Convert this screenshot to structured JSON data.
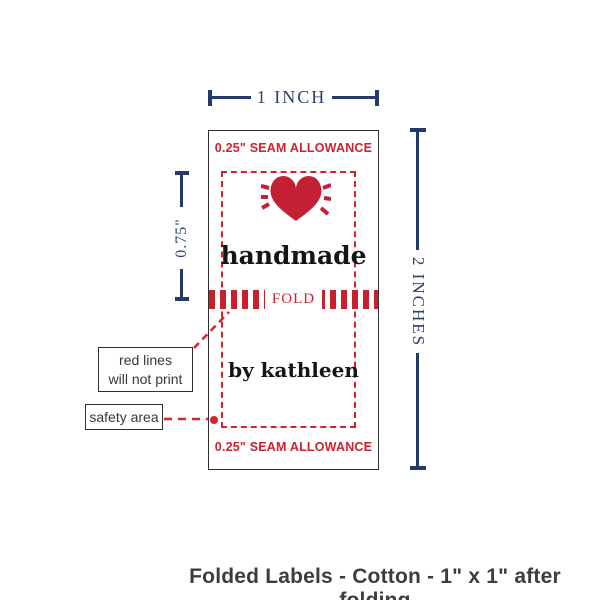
{
  "colors": {
    "navy": "#253a6b",
    "red": "#cf2130",
    "heart_red": "#c32133",
    "ink": "#151515",
    "outline": "#2f2f2f",
    "caption_gray": "#3d3d3d"
  },
  "dimensions": {
    "width_label": "1 INCH",
    "height_label": "2 INCHES",
    "fold_half_label": "0.75\""
  },
  "label": {
    "seam_top": "0.25\" SEAM ALLOWANCE",
    "seam_bottom": "0.25\" SEAM ALLOWANCE",
    "heart_icon": "heart-with-rays",
    "brand_line1": "handmade",
    "fold_label": "FOLD",
    "brand_line2": "by kathleen"
  },
  "callouts": {
    "red_lines": {
      "line1": "red lines",
      "line2": "will not print"
    },
    "safety_area": {
      "label": "safety area"
    }
  },
  "caption": {
    "text": "Folded Labels - Cotton - 1\" x 1\" after folding"
  }
}
